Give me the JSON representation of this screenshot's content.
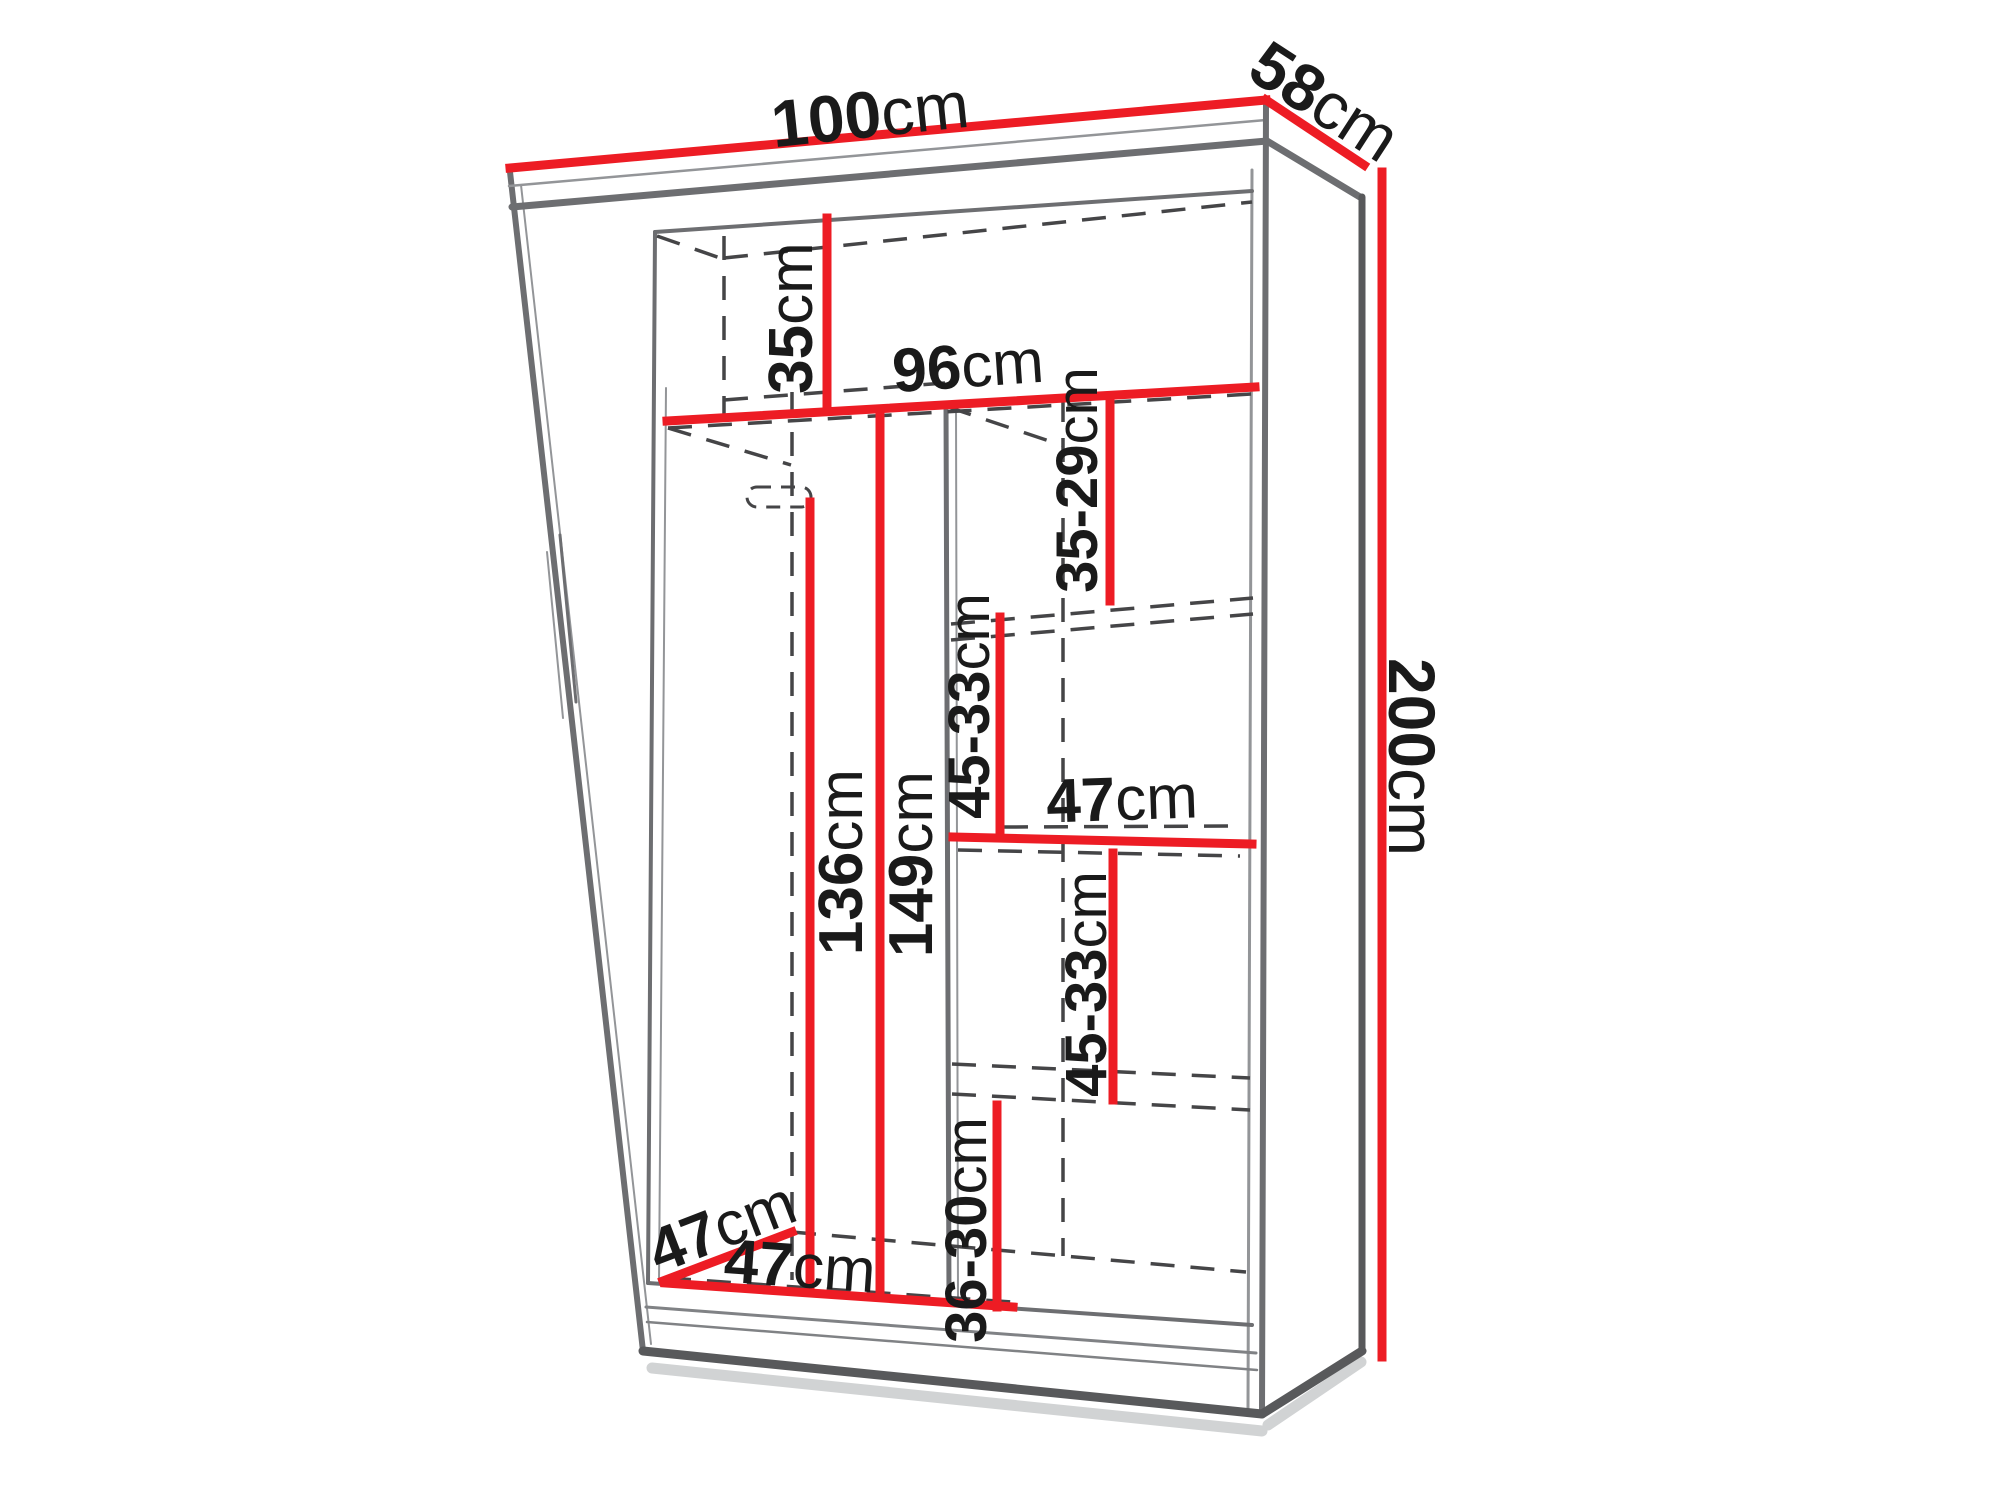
{
  "diagram": {
    "kind": "wardrobe-dimension-drawing",
    "colors": {
      "dimension_red": "#ed1c24",
      "edge_dark": "#58595b",
      "edge_mid": "#6d6e71",
      "edge_light": "#939598",
      "track_gray": "#808285",
      "shadow": "#d1d3d4",
      "dashed": "#454547",
      "text": "#1a1a1a",
      "background": "#ffffff"
    },
    "labels": [
      {
        "id": "width-top",
        "value": "100",
        "unit": "cm",
        "x": 870,
        "y": 114,
        "rotate": -6,
        "size": 66
      },
      {
        "id": "depth-top",
        "value": "58",
        "unit": "cm",
        "x": 1325,
        "y": 101,
        "rotate": 33,
        "size": 66
      },
      {
        "id": "height-right",
        "value": "200",
        "unit": "cm",
        "x": 1412,
        "y": 757,
        "rotate": 90,
        "size": 66
      },
      {
        "id": "top-shelf-height",
        "value": "35",
        "unit": "cm",
        "x": 791,
        "y": 318,
        "rotate": -90,
        "size": 62
      },
      {
        "id": "interior-width",
        "value": "96",
        "unit": "cm",
        "x": 968,
        "y": 366,
        "rotate": -4,
        "size": 62
      },
      {
        "id": "shelf-gap-1",
        "value": "35-29",
        "unit": "cm",
        "x": 1077,
        "y": 480,
        "rotate": -90,
        "size": 58
      },
      {
        "id": "shelf-gap-2",
        "value": "45-33",
        "unit": "cm",
        "x": 969,
        "y": 706,
        "rotate": -90,
        "size": 58
      },
      {
        "id": "shelf-width",
        "value": "47",
        "unit": "cm",
        "x": 1122,
        "y": 799,
        "rotate": -2,
        "size": 62
      },
      {
        "id": "shelf-gap-3",
        "value": "45-33",
        "unit": "cm",
        "x": 1086,
        "y": 984,
        "rotate": -90,
        "size": 58
      },
      {
        "id": "shelf-gap-4",
        "value": "36-30",
        "unit": "cm",
        "x": 966,
        "y": 1230,
        "rotate": -90,
        "size": 58
      },
      {
        "id": "hanging-height-1",
        "value": "136",
        "unit": "cm",
        "x": 841,
        "y": 862,
        "rotate": -90,
        "size": 62
      },
      {
        "id": "hanging-height-2",
        "value": "149",
        "unit": "cm",
        "x": 911,
        "y": 864,
        "rotate": -90,
        "size": 62
      },
      {
        "id": "depth-bottom",
        "value": "47",
        "unit": "cm",
        "x": 722,
        "y": 1227,
        "rotate": -21,
        "size": 62
      },
      {
        "id": "bottom-width",
        "value": "47",
        "unit": "cm",
        "x": 800,
        "y": 1266,
        "rotate": 4,
        "size": 62
      }
    ],
    "dimension_lines": [
      {
        "id": "width-top",
        "x1": 510,
        "y1": 168,
        "x2": 1266,
        "y2": 100,
        "w": 9
      },
      {
        "id": "depth-top",
        "x1": 1266,
        "y1": 100,
        "x2": 1364,
        "y2": 165,
        "w": 9
      },
      {
        "id": "height-right",
        "x1": 1382,
        "y1": 172,
        "x2": 1382,
        "y2": 1357,
        "w": 9
      },
      {
        "id": "top-shelf-height",
        "x1": 827,
        "y1": 218,
        "x2": 827,
        "y2": 407,
        "w": 9
      },
      {
        "id": "interior-width",
        "x1": 667,
        "y1": 421,
        "x2": 1255,
        "y2": 387,
        "w": 9
      },
      {
        "id": "shelf-gap-1",
        "x1": 1110,
        "y1": 398,
        "x2": 1110,
        "y2": 601,
        "w": 9
      },
      {
        "id": "shelf-gap-2",
        "x1": 1000,
        "y1": 617,
        "x2": 1000,
        "y2": 838,
        "w": 9
      },
      {
        "id": "shelf-width",
        "x1": 953,
        "y1": 837,
        "x2": 1252,
        "y2": 844,
        "w": 9
      },
      {
        "id": "shelf-gap-3",
        "x1": 1113,
        "y1": 853,
        "x2": 1113,
        "y2": 1100,
        "w": 9
      },
      {
        "id": "shelf-gap-4",
        "x1": 997,
        "y1": 1105,
        "x2": 997,
        "y2": 1307,
        "w": 9
      },
      {
        "id": "hanging-height-1",
        "x1": 810,
        "y1": 502,
        "x2": 810,
        "y2": 1290,
        "w": 9
      },
      {
        "id": "hanging-height-2",
        "x1": 880,
        "y1": 409,
        "x2": 880,
        "y2": 1295,
        "w": 9
      },
      {
        "id": "depth-bottom",
        "x1": 663,
        "y1": 1281,
        "x2": 792,
        "y2": 1232,
        "w": 9
      },
      {
        "id": "bottom-width",
        "x1": 665,
        "y1": 1283,
        "x2": 1013,
        "y2": 1307,
        "w": 9
      }
    ],
    "solid_lines": [
      {
        "id": "shadow-bottom",
        "x1": 652,
        "y1": 1368,
        "x2": 1262,
        "y2": 1431,
        "w": 11,
        "c": "shadow"
      },
      {
        "id": "shadow-side",
        "x1": 1268,
        "y1": 1425,
        "x2": 1361,
        "y2": 1362,
        "w": 11,
        "c": "shadow"
      },
      {
        "id": "front-left-edge",
        "x1": 510,
        "y1": 172,
        "x2": 643,
        "y2": 1351,
        "w": 6,
        "c": "edge_mid"
      },
      {
        "id": "front-left-inner",
        "x1": 521,
        "y1": 185,
        "x2": 651,
        "y2": 1344,
        "w": 2,
        "c": "edge_light"
      },
      {
        "id": "crown-thin",
        "x1": 509,
        "y1": 186,
        "x2": 1266,
        "y2": 120,
        "w": 2.5,
        "c": "edge_light"
      },
      {
        "id": "crown-front",
        "x1": 512,
        "y1": 207,
        "x2": 1267,
        "y2": 141,
        "w": 7,
        "c": "edge_mid"
      },
      {
        "id": "side-top-edge",
        "x1": 1267,
        "y1": 141,
        "x2": 1360,
        "y2": 197,
        "w": 7,
        "c": "edge_mid"
      },
      {
        "id": "front-right-edge",
        "x1": 1266,
        "y1": 104,
        "x2": 1262,
        "y2": 1414,
        "w": 6,
        "c": "edge_mid"
      },
      {
        "id": "front-right-inner",
        "x1": 1252,
        "y1": 170,
        "x2": 1248,
        "y2": 1408,
        "w": 3,
        "c": "edge_light"
      },
      {
        "id": "back-right-edge",
        "x1": 1362,
        "y1": 197,
        "x2": 1362,
        "y2": 1351,
        "w": 7,
        "c": "edge_dark"
      },
      {
        "id": "side-bottom-edge",
        "x1": 1262,
        "y1": 1414,
        "x2": 1362,
        "y2": 1351,
        "w": 9,
        "c": "edge_dark"
      },
      {
        "id": "front-bottom-edge",
        "x1": 643,
        "y1": 1351,
        "x2": 1262,
        "y2": 1414,
        "w": 9,
        "c": "edge_dark"
      },
      {
        "id": "interior-ceiling",
        "x1": 655,
        "y1": 232,
        "x2": 1252,
        "y2": 191,
        "w": 4,
        "c": "edge_mid"
      },
      {
        "id": "interior-left",
        "x1": 655,
        "y1": 232,
        "x2": 648,
        "y2": 1283,
        "w": 4,
        "c": "edge_mid"
      },
      {
        "id": "interior-left-2",
        "x1": 666,
        "y1": 388,
        "x2": 659,
        "y2": 1281,
        "w": 2,
        "c": "edge_light"
      },
      {
        "id": "interior-floor",
        "x1": 648,
        "y1": 1283,
        "x2": 1252,
        "y2": 1325,
        "w": 4,
        "c": "edge_mid"
      },
      {
        "id": "divider-front",
        "x1": 946,
        "y1": 403,
        "x2": 949,
        "y2": 1301,
        "w": 5,
        "c": "edge_mid"
      },
      {
        "id": "divider-inner",
        "x1": 956,
        "y1": 405,
        "x2": 958,
        "y2": 1300,
        "w": 2,
        "c": "edge_light"
      },
      {
        "id": "door-track-1",
        "x1": 646,
        "y1": 1307,
        "x2": 1256,
        "y2": 1353,
        "w": 3,
        "c": "track_gray"
      },
      {
        "id": "door-track-2",
        "x1": 647,
        "y1": 1322,
        "x2": 1257,
        "y2": 1370,
        "w": 2.5,
        "c": "track_gray"
      },
      {
        "id": "mirror-stroke-1",
        "x1": 560,
        "y1": 535,
        "x2": 576,
        "y2": 702,
        "w": 3,
        "c": "edge_mid"
      },
      {
        "id": "mirror-stroke-2",
        "x1": 547,
        "y1": 552,
        "x2": 563,
        "y2": 718,
        "w": 2,
        "c": "edge_light"
      }
    ],
    "dashed_lines": [
      {
        "id": "back-ceiling",
        "x1": 724,
        "y1": 258,
        "x2": 1252,
        "y2": 202
      },
      {
        "id": "corner-depth-top",
        "x1": 657,
        "y1": 236,
        "x2": 723,
        "y2": 259
      },
      {
        "id": "back-vertical-a",
        "x1": 724,
        "y1": 236,
        "x2": 724,
        "y2": 418
      },
      {
        "id": "back-vertical-b",
        "x1": 792,
        "y1": 392,
        "x2": 792,
        "y2": 1280
      },
      {
        "id": "back-vertical-c",
        "x1": 1063,
        "y1": 398,
        "x2": 1063,
        "y2": 1256
      },
      {
        "id": "shelf1-hidden",
        "x1": 668,
        "y1": 428,
        "x2": 1252,
        "y2": 394
      },
      {
        "id": "shelf1-depth-left",
        "x1": 668,
        "y1": 428,
        "x2": 791,
        "y2": 465
      },
      {
        "id": "shelf1-back",
        "x1": 724,
        "y1": 400,
        "x2": 945,
        "y2": 383
      },
      {
        "id": "shelf1-depth-right",
        "x1": 948,
        "y1": 407,
        "x2": 1064,
        "y2": 446
      },
      {
        "id": "shelf2-front",
        "x1": 951,
        "y1": 624,
        "x2": 1253,
        "y2": 598
      },
      {
        "id": "shelf2-bottom",
        "x1": 951,
        "y1": 640,
        "x2": 1253,
        "y2": 614
      },
      {
        "id": "shelf3-back",
        "x1": 1004,
        "y1": 827,
        "x2": 1242,
        "y2": 826
      },
      {
        "id": "shelf3-bottom",
        "x1": 958,
        "y1": 850,
        "x2": 1240,
        "y2": 856
      },
      {
        "id": "shelf4-front",
        "x1": 952,
        "y1": 1064,
        "x2": 1250,
        "y2": 1078
      },
      {
        "id": "shelf4-bottom",
        "x1": 952,
        "y1": 1094,
        "x2": 1250,
        "y2": 1110
      },
      {
        "id": "back-floor",
        "x1": 792,
        "y1": 1232,
        "x2": 1246,
        "y2": 1272
      },
      {
        "id": "floor-hidden-front",
        "x1": 667,
        "y1": 1278,
        "x2": 1012,
        "y2": 1302
      }
    ],
    "rail_bracket": {
      "x": 747,
      "y": 487,
      "w": 64,
      "h": 20,
      "r": 10
    }
  }
}
